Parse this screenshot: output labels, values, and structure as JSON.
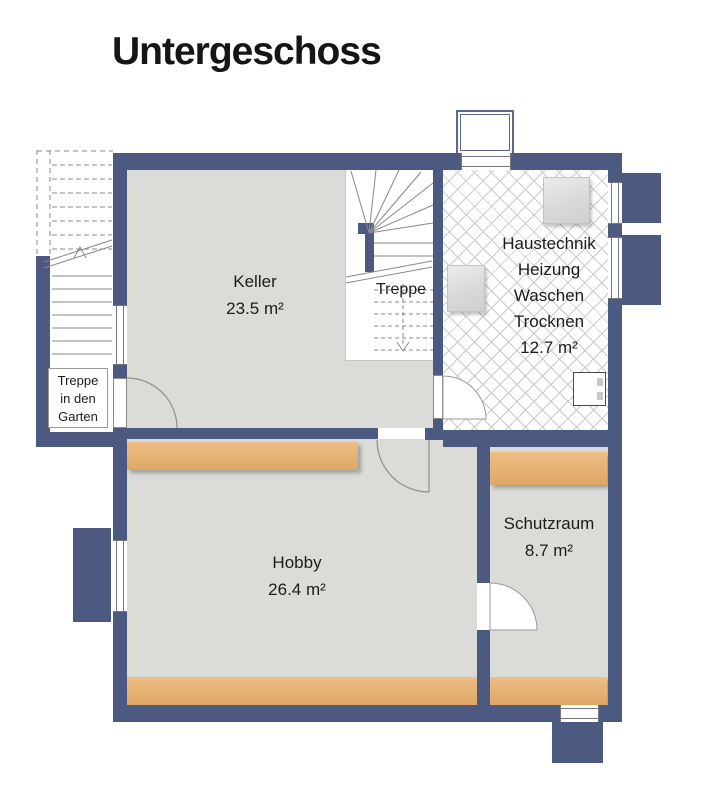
{
  "title": "Untergeschoss",
  "rooms": {
    "keller": {
      "name": "Keller",
      "area": "23.5 m²"
    },
    "haustechnik": {
      "lines": [
        "Haustechnik",
        "Heizung",
        "Waschen",
        "Trocknen",
        "12.7 m²"
      ]
    },
    "hobby": {
      "name": "Hobby",
      "area": "26.4 m²"
    },
    "schutzraum": {
      "name": "Schutzraum",
      "area": "8.7 m²"
    },
    "treppe": {
      "name": "Treppe"
    },
    "garden_stair": {
      "lines": [
        "Treppe",
        "in den",
        "Garten"
      ]
    }
  },
  "colors": {
    "wall": "#4c5a82",
    "floor": "#dbdbd8",
    "wood": "#eebe85",
    "wood2": "#dfa765",
    "tile_line": "#c7cbce",
    "text": "#1c1c1c"
  }
}
